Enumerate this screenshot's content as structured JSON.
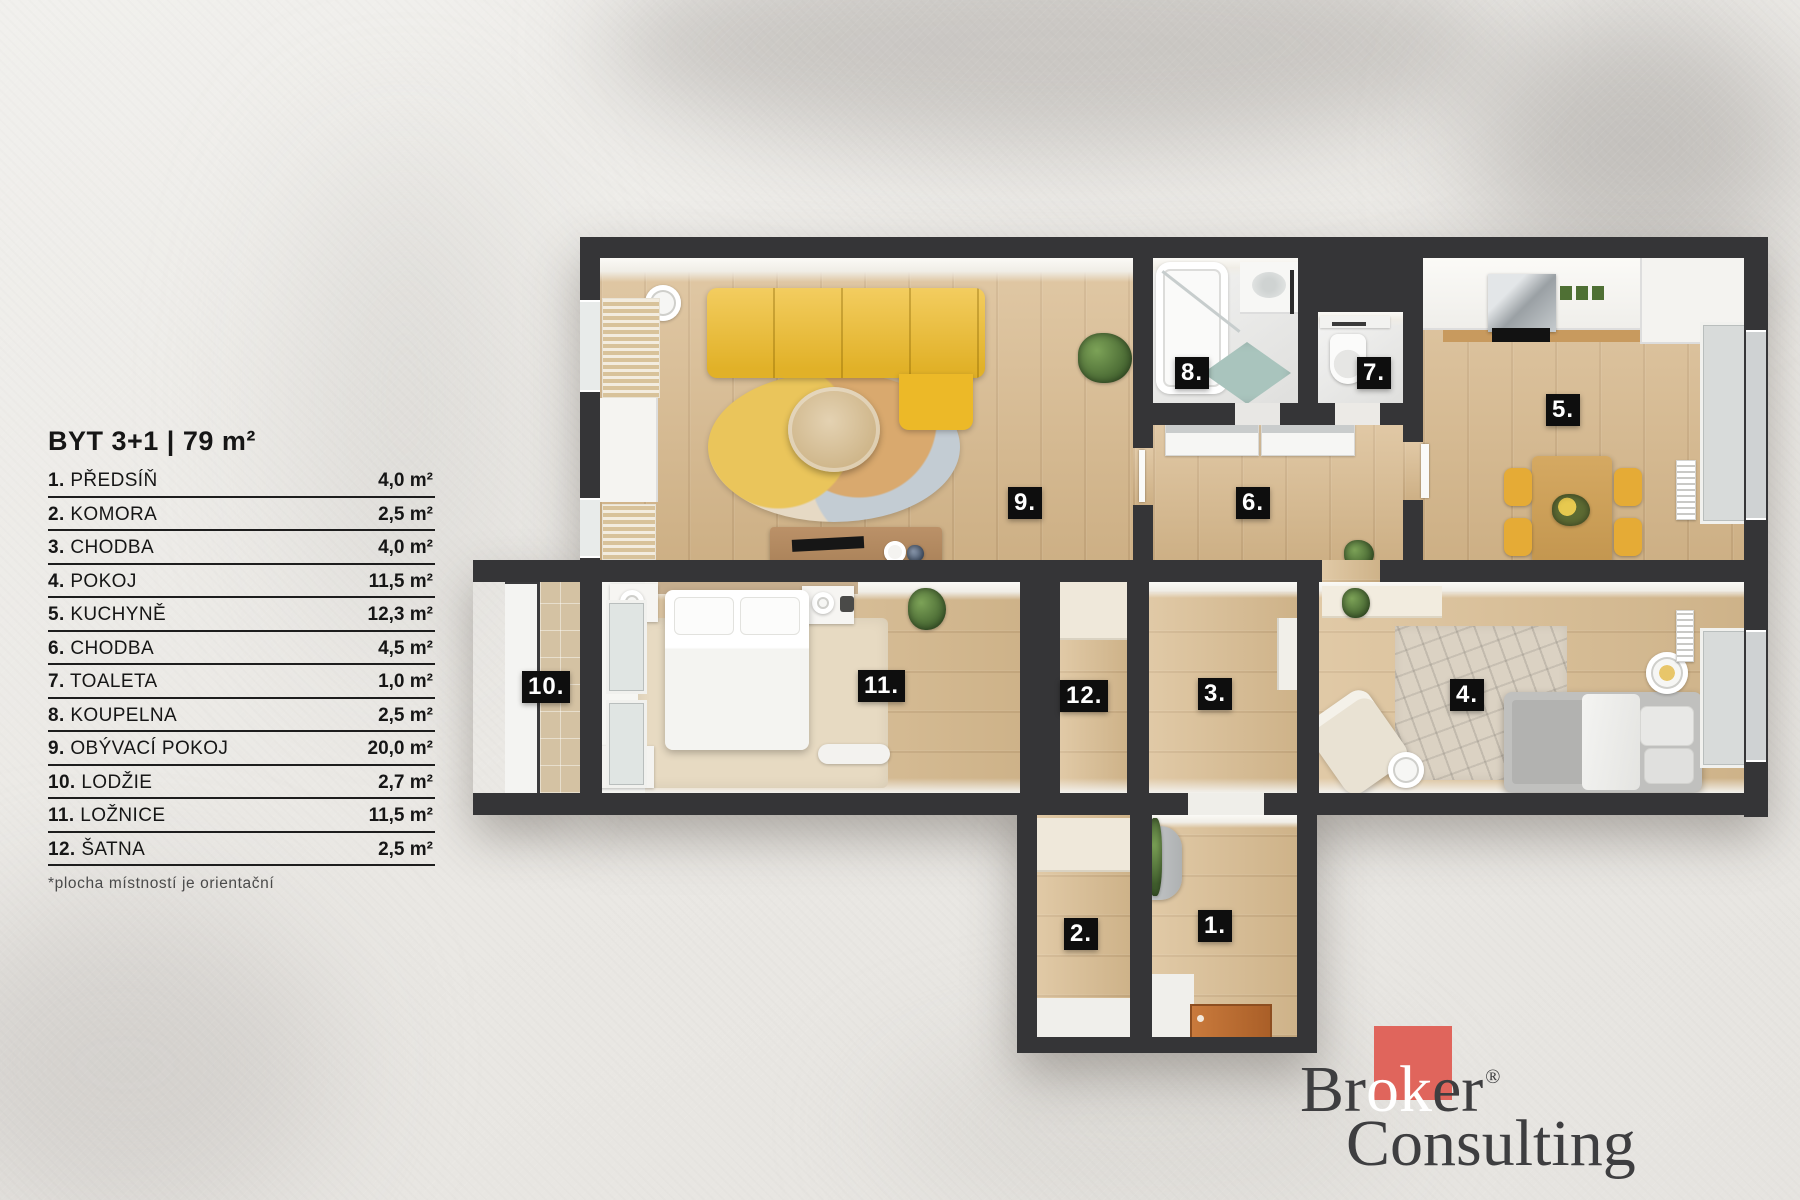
{
  "legend": {
    "title": "BYT 3+1 | 79 m²",
    "items": [
      {
        "num": "1.",
        "label": "PŘEDSÍŇ",
        "area": "4,0 m²"
      },
      {
        "num": "2.",
        "label": "KOMORA",
        "area": "2,5 m²"
      },
      {
        "num": "3.",
        "label": "CHODBA",
        "area": "4,0 m²"
      },
      {
        "num": "4.",
        "label": "POKOJ",
        "area": "11,5 m²"
      },
      {
        "num": "5.",
        "label": "KUCHYNĚ",
        "area": "12,3 m²"
      },
      {
        "num": "6.",
        "label": "CHODBA",
        "area": "4,5 m²"
      },
      {
        "num": "7.",
        "label": "TOALETA",
        "area": "1,0 m²"
      },
      {
        "num": "8.",
        "label": "KOUPELNA",
        "area": "2,5 m²"
      },
      {
        "num": "9.",
        "label": "OBÝVACÍ POKOJ",
        "area": "20,0 m²"
      },
      {
        "num": "10.",
        "label": "LODŽIE",
        "area": "2,7 m²"
      },
      {
        "num": "11.",
        "label": "LOŽNICE",
        "area": "11,5 m²"
      },
      {
        "num": "12.",
        "label": "ŠATNA",
        "area": "2,5 m²"
      }
    ],
    "footnote": "*plocha místností je orientační"
  },
  "plan": {
    "labels": [
      {
        "text": "1."
      },
      {
        "text": "2."
      },
      {
        "text": "3."
      },
      {
        "text": "4."
      },
      {
        "text": "5."
      },
      {
        "text": "6."
      },
      {
        "text": "7."
      },
      {
        "text": "8."
      },
      {
        "text": "9."
      },
      {
        "text": "10."
      },
      {
        "text": "11."
      },
      {
        "text": "12."
      }
    ],
    "colors": {
      "wall": "#353537",
      "wood_floor": "#d8b98c",
      "sofa_yellow": "#efbc2a",
      "chair_yellow": "#e5ab36",
      "teal_rug": "#a9c4bd",
      "label_bg": "#0e0e0e",
      "entry_mat": "#bf7134"
    }
  },
  "logo": {
    "line1_pre": "Br",
    "line1_mid": "ok",
    "line1_post": "er",
    "registered": "®",
    "line2": "Consulting",
    "red": "#e0655c",
    "text_color": "#3e3e40"
  }
}
